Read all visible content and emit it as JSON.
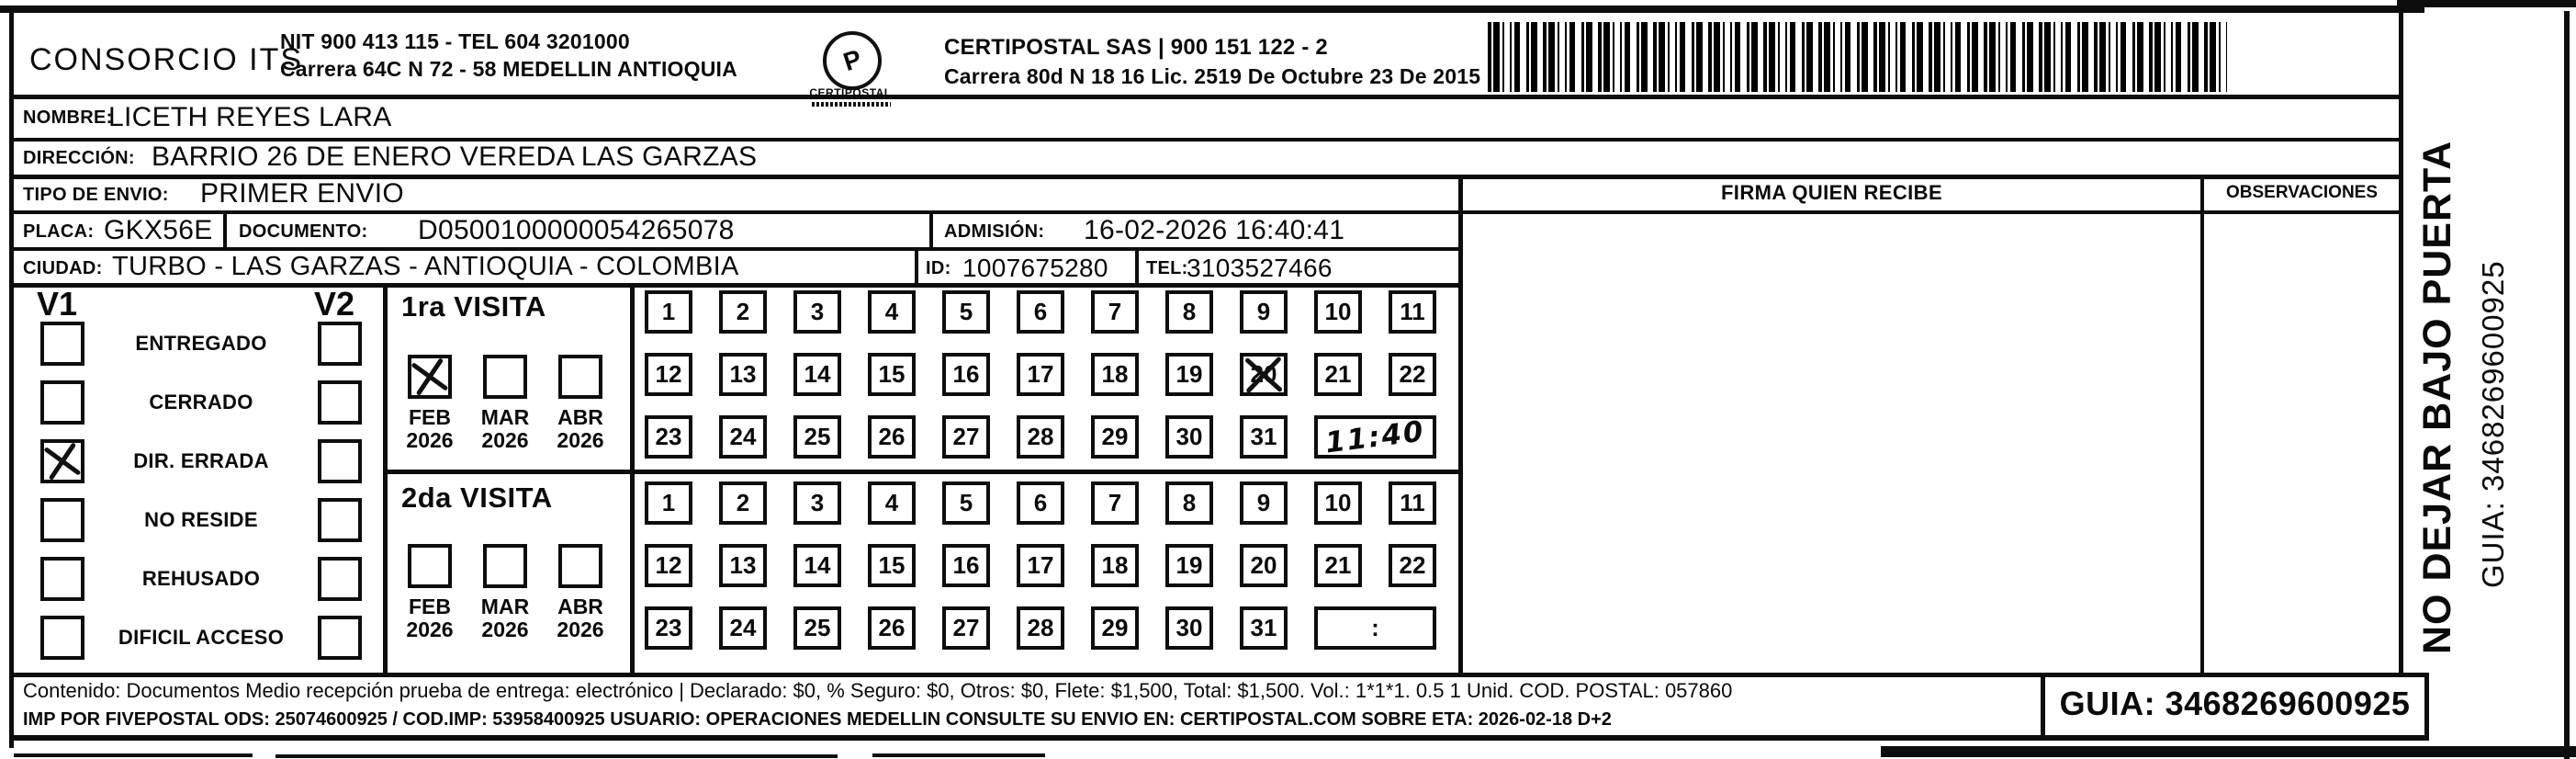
{
  "header": {
    "company_name": "CONSORCIO ITS",
    "nit_line": "NIT 900 413 115 - TEL 604 3201000",
    "address_line": "Carrera 64C N 72 - 58 MEDELLIN ANTIOQUIA",
    "logo_text": "CERTIPOSTAL",
    "certipostal_line1": "CERTIPOSTAL SAS | 900 151 122 - 2",
    "certipostal_line2": "Carrera 80d N 18 16  Lic. 2519 De Octubre 23 De 2015"
  },
  "shipment": {
    "nombre_label": "NOMBRE:",
    "nombre": "LICETH REYES LARA",
    "direccion_label": "DIRECCIÓN:",
    "direccion": "BARRIO 26 DE ENERO VEREDA LAS GARZAS",
    "tipo_envio_label": "TIPO DE ENVIO:",
    "tipo_envio": "PRIMER ENVIO",
    "placa_label": "PLACA:",
    "placa": "GKX56E",
    "documento_label": "DOCUMENTO:",
    "documento": "D0500100000054265078",
    "admision_label": "ADMISIÓN:",
    "admision": "16-02-2026 16:40:41",
    "ciudad_label": "CIUDAD:",
    "ciudad": "TURBO - LAS GARZAS - ANTIOQUIA - COLOMBIA",
    "id_label": "ID:",
    "id_value": "1007675280",
    "tel_label": "TEL:",
    "tel_value": "3103527466"
  },
  "columns": {
    "firma_header": "FIRMA QUIEN RECIBE",
    "observaciones_header": "OBSERVACIONES"
  },
  "status_panel": {
    "v1_header": "V1",
    "v2_header": "V2",
    "rows": [
      {
        "label": "ENTREGADO",
        "v1": false,
        "v2": false
      },
      {
        "label": "CERRADO",
        "v1": false,
        "v2": false
      },
      {
        "label": "DIR. ERRADA",
        "v1": true,
        "v2": false
      },
      {
        "label": "NO RESIDE",
        "v1": false,
        "v2": false
      },
      {
        "label": "REHUSADO",
        "v1": false,
        "v2": false
      },
      {
        "label": "DIFICIL ACCESO",
        "v1": false,
        "v2": false
      }
    ]
  },
  "visits": [
    {
      "title": "1ra VISITA",
      "months": [
        {
          "month": "FEB",
          "year": "2026",
          "checked": true
        },
        {
          "month": "MAR",
          "year": "2026",
          "checked": false
        },
        {
          "month": "ABR",
          "year": "2026",
          "checked": false
        }
      ],
      "days": [
        "1",
        "2",
        "3",
        "4",
        "5",
        "6",
        "7",
        "8",
        "9",
        "10",
        "11",
        "12",
        "13",
        "14",
        "15",
        "16",
        "17",
        "18",
        "19",
        "20",
        "21",
        "22",
        "23",
        "24",
        "25",
        "26",
        "27",
        "28",
        "29",
        "30",
        "31"
      ],
      "crossed_days": [
        "20"
      ],
      "time_value": "11:40",
      "time_handwritten": true
    },
    {
      "title": "2da VISITA",
      "months": [
        {
          "month": "FEB",
          "year": "2026",
          "checked": false
        },
        {
          "month": "MAR",
          "year": "2026",
          "checked": false
        },
        {
          "month": "ABR",
          "year": "2026",
          "checked": false
        }
      ],
      "days": [
        "1",
        "2",
        "3",
        "4",
        "5",
        "6",
        "7",
        "8",
        "9",
        "10",
        "11",
        "12",
        "13",
        "14",
        "15",
        "16",
        "17",
        "18",
        "19",
        "20",
        "21",
        "22",
        "23",
        "24",
        "25",
        "26",
        "27",
        "28",
        "29",
        "30",
        "31"
      ],
      "crossed_days": [],
      "time_value": ":",
      "time_handwritten": false
    }
  ],
  "side_text": {
    "warning": "NO DEJAR BAJO PUERTA",
    "guia": "GUIA: 3468269600925"
  },
  "footer": {
    "line1": "Contenido: Documentos Medio recepción prueba de entrega: electrónico | Declarado: $0, % Seguro: $0, Otros: $0, Flete: $1,500, Total: $1,500. Vol.: 1*1*1. 0.5  1 Unid. COD. POSTAL: 057860",
    "line2": "IMP POR FIVEPOSTAL ODS: 25074600925 / COD.IMP: 53958400925 USUARIO: OPERACIONES MEDELLIN CONSULTE SU ENVIO EN: CERTIPOSTAL.COM SOBRE ETA: 2026-02-18 D+2",
    "guia_box": "GUIA: 3468269600925"
  },
  "colors": {
    "ink": "#0d0d0d",
    "paper": "#ffffff"
  }
}
